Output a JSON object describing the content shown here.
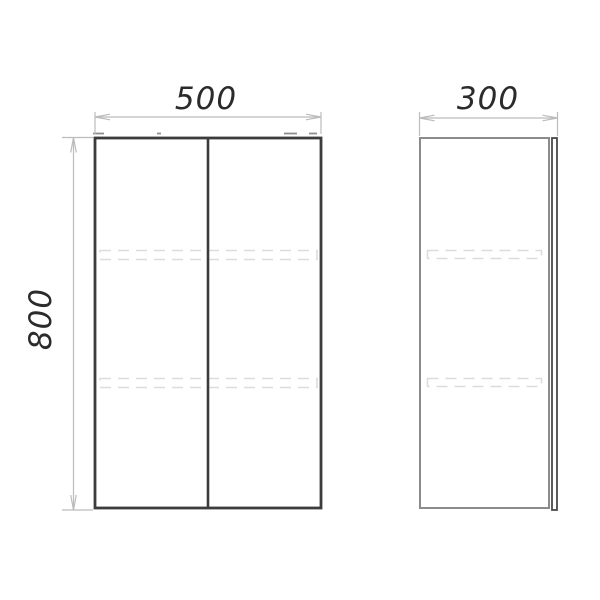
{
  "title": "Cabinet technical drawing, orthographic front and side views",
  "drawing": {
    "views": [
      {
        "id": "front",
        "description": "Front view: two-door cabinet with center door gap, two hidden shelves shown dashed, hidden hardware marks along top edge",
        "width_mm": 500,
        "height_mm": 800
      },
      {
        "id": "side",
        "description": "Side view: cabinet carcass with door panel edge at front (right) side, two hidden shelves shown dashed",
        "depth_mm": 300,
        "height_mm": 800
      }
    ],
    "dimensions": {
      "width": {
        "value": "500",
        "orientation": "horizontal",
        "applies_to": "front view top"
      },
      "depth": {
        "value": "300",
        "orientation": "horizontal",
        "applies_to": "side view top"
      },
      "height": {
        "value": "800",
        "orientation": "vertical",
        "applies_to": "front view left"
      }
    },
    "colors": {
      "background": "#ffffff",
      "outline_dark": "#3c3c3c",
      "outline_medium": "#8b8b8b",
      "door_edge": "#4a4a4a",
      "hidden_line": "#dcdcdc",
      "hidden_marks": "#8d8d8d",
      "dimension_line": "#bcbcbc",
      "label_text": "#2b2b2b"
    }
  }
}
